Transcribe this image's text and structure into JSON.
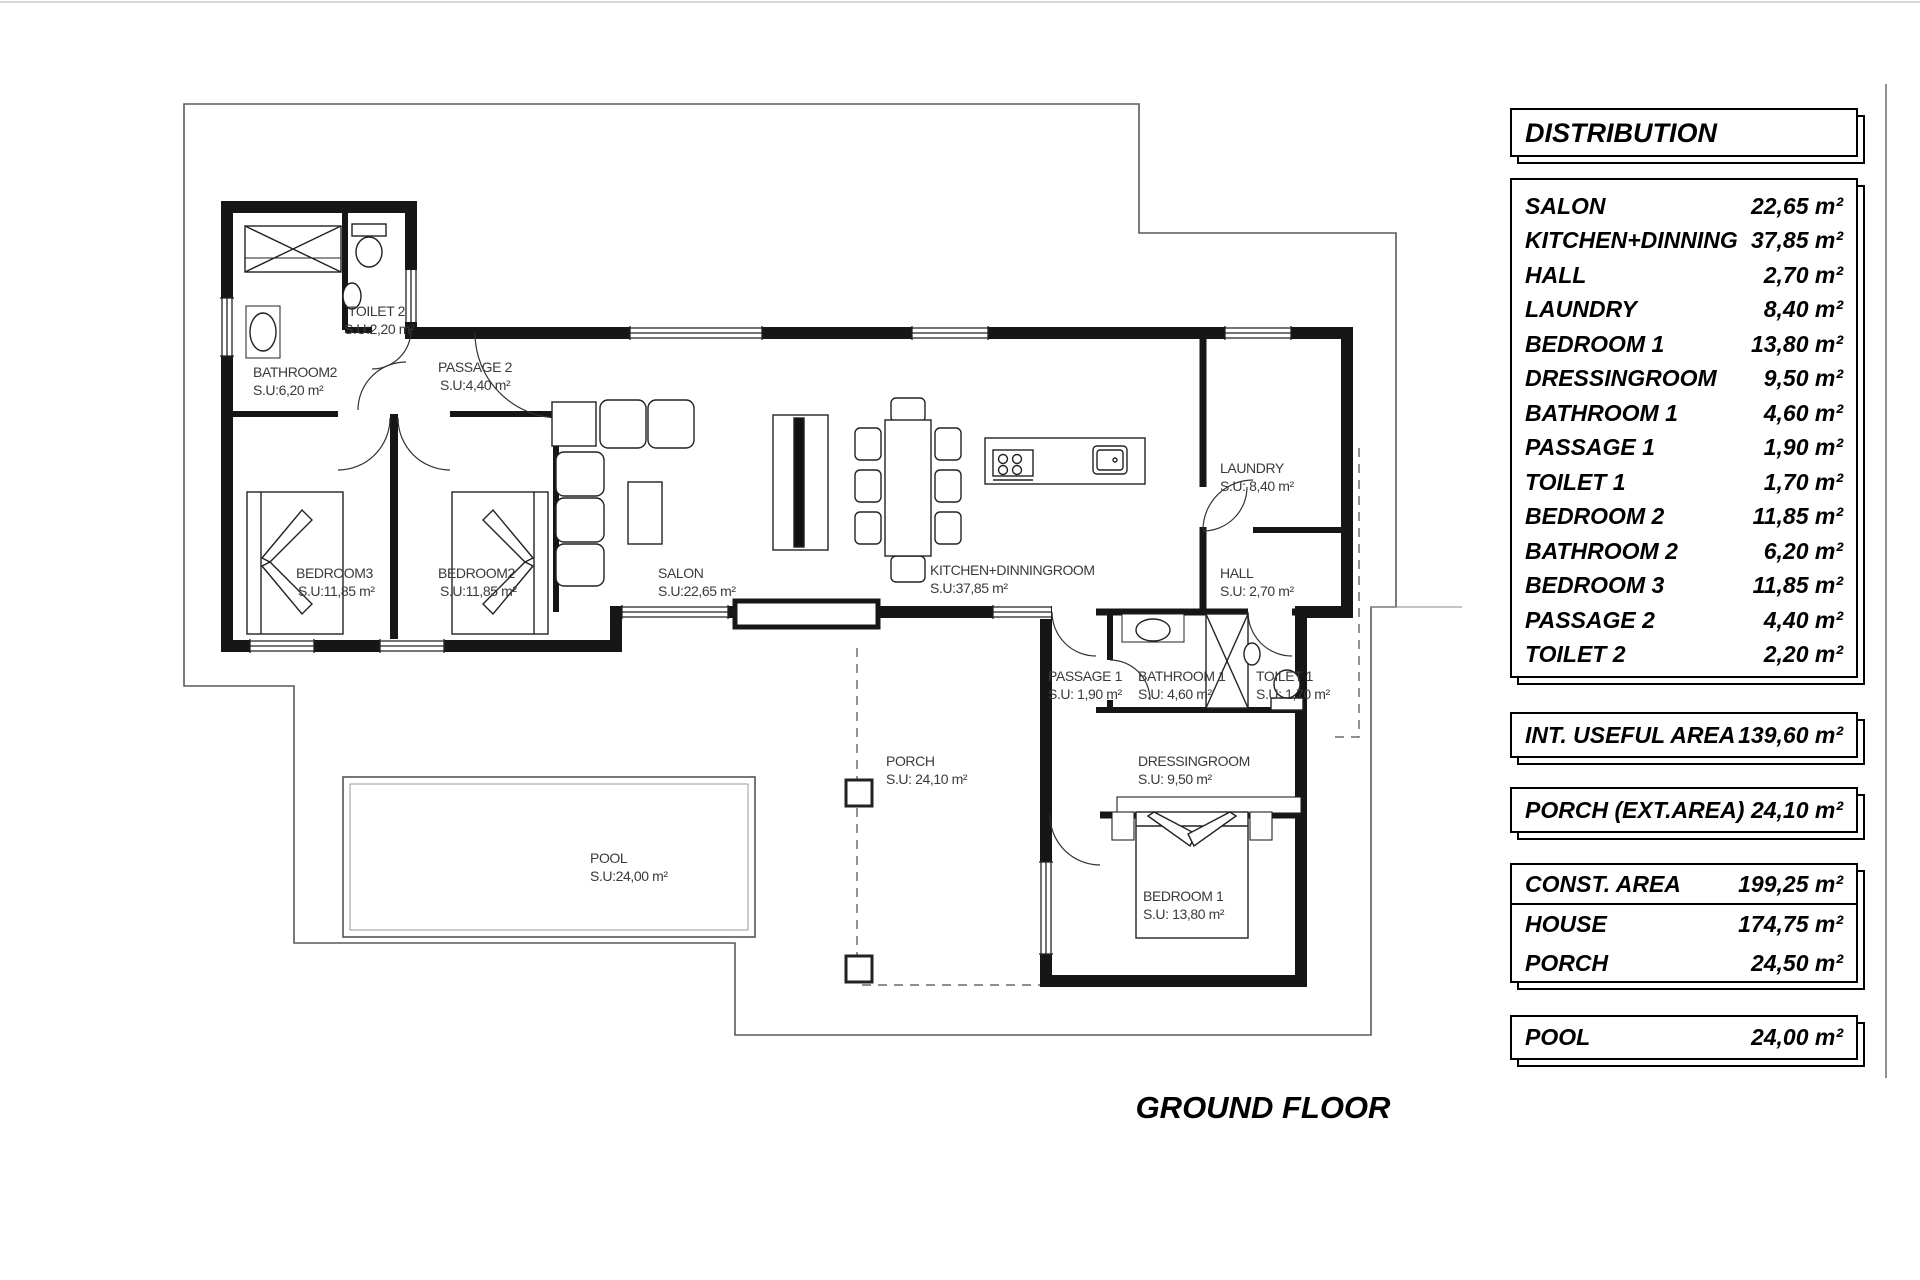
{
  "plan": {
    "floor_title": "GROUND FLOOR",
    "rooms": [
      {
        "name": "TOILET 2",
        "area": "S.U:2,20 m²"
      },
      {
        "name": "BATHROOM2",
        "area": "S.U:6,20 m²"
      },
      {
        "name": "PASSAGE 2",
        "area": "S.U:4,40 m²"
      },
      {
        "name": "BEDROOM3",
        "area": "S.U:11,85 m²"
      },
      {
        "name": "BEDROOM2",
        "area": "S.U:11,85 m²"
      },
      {
        "name": "SALON",
        "area": "S.U:22,65 m²"
      },
      {
        "name": "KITCHEN+DINNINGROOM",
        "area": "S.U:37,85 m²"
      },
      {
        "name": "LAUNDRY",
        "area": "S.U: 8,40 m²"
      },
      {
        "name": "HALL",
        "area": "S.U: 2,70 m²"
      },
      {
        "name": "PASSAGE 1",
        "area": "S.U: 1,90 m²"
      },
      {
        "name": "BATHROOM 1",
        "area": "S.U: 4,60 m²"
      },
      {
        "name": "TOILET 1",
        "area": "S.U: 1,70 m²"
      },
      {
        "name": "DRESSINGROOM",
        "area": "S.U: 9,50 m²"
      },
      {
        "name": "BEDROOM 1",
        "area": "S.U: 13,80 m²"
      },
      {
        "name": "PORCH",
        "area": "S.U: 24,10 m²"
      },
      {
        "name": "POOL",
        "area": "S.U:24,00 m²"
      }
    ]
  },
  "distribution": {
    "title": "DISTRIBUTION",
    "rows": [
      {
        "label": "SALON",
        "value": "22,65 m²"
      },
      {
        "label": "KITCHEN+DINNING",
        "value": "37,85 m²"
      },
      {
        "label": "HALL",
        "value": "2,70 m²"
      },
      {
        "label": "LAUNDRY",
        "value": "8,40 m²"
      },
      {
        "label": "BEDROOM 1",
        "value": "13,80 m²"
      },
      {
        "label": "DRESSINGROOM",
        "value": "9,50 m²"
      },
      {
        "label": "BATHROOM 1",
        "value": "4,60 m²"
      },
      {
        "label": "PASSAGE 1",
        "value": "1,90 m²"
      },
      {
        "label": "TOILET 1",
        "value": "1,70 m²"
      },
      {
        "label": "BEDROOM 2",
        "value": "11,85 m²"
      },
      {
        "label": "BATHROOM 2",
        "value": "6,20 m²"
      },
      {
        "label": "BEDROOM 3",
        "value": "11,85 m²"
      },
      {
        "label": "PASSAGE 2",
        "value": "4,40 m²"
      },
      {
        "label": "TOILET 2",
        "value": "2,20 m²"
      }
    ],
    "int_useful_area": {
      "label": "INT. USEFUL AREA",
      "value": "139,60 m²"
    },
    "porch_ext": {
      "label": "PORCH (EXT.AREA)",
      "value": "24,10 m²"
    },
    "const_area": [
      {
        "label": "CONST. AREA",
        "value": "199,25 m²"
      },
      {
        "label": "HOUSE",
        "value": "174,75 m²"
      },
      {
        "label": "PORCH",
        "value": "24,50 m²"
      }
    ],
    "pool": {
      "label": "POOL",
      "value": "24,00 m²"
    }
  }
}
